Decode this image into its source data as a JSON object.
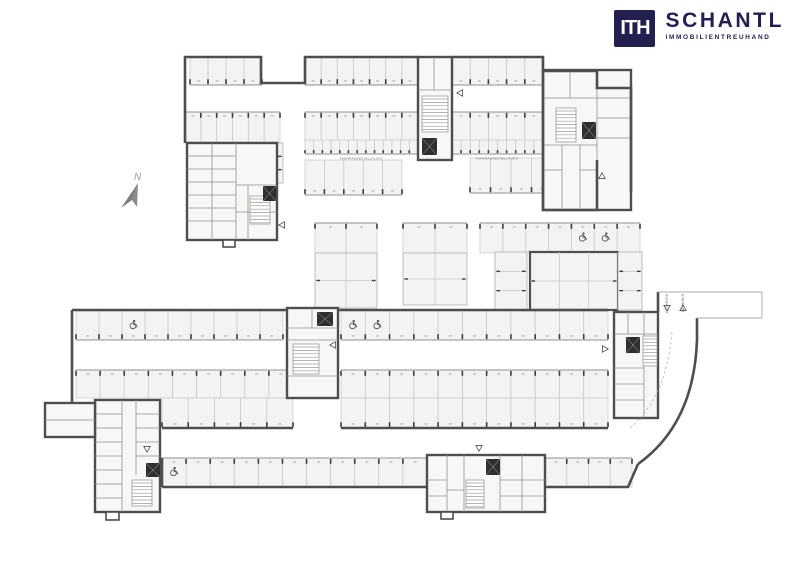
{
  "logo": {
    "mark": "ITH",
    "name": "SCHANTL",
    "tagline": "IMMOBILIENTREUHAND",
    "color": "#23204f"
  },
  "compass": {
    "label": "N"
  },
  "labels": [
    {
      "id": "bike-left",
      "text": "FAHRRADABSTELLPLATZ",
      "x": 361,
      "y": 159.5,
      "size": 3.1,
      "rot": 0
    },
    {
      "id": "bike-right",
      "text": "FAHRRADABSTELLPLATZ",
      "x": 497,
      "y": 159.5,
      "size": 3.1,
      "rot": 0
    },
    {
      "id": "ausfahrt",
      "text": "AUSFAHRT",
      "x": 665.5,
      "y": 294,
      "size": 3.4,
      "rot": 90
    },
    {
      "id": "einfahrt",
      "text": "EINFAHRT",
      "x": 681.5,
      "y": 294,
      "size": 3.4,
      "rot": 90
    }
  ],
  "colors": {
    "wall": "#4e4e4e",
    "stall": "#f3f3f1",
    "stallLine": "#c6c6c3",
    "headLine": "#8f8f8c",
    "tick": "#3c3c3c",
    "icon": "#57575c",
    "room": "#f7f7f5",
    "thin": "#a9a9a6",
    "dash": "#b2b2af",
    "numberDash": "#a0a09d",
    "text": "#6f6f6c",
    "compass": "#8b8b8b"
  },
  "plan": {
    "rows": [
      {
        "x": 190,
        "y": 57,
        "w": 72,
        "h": 28,
        "n": 4,
        "head": "b"
      },
      {
        "x": 305,
        "y": 57,
        "w": 113,
        "h": 28,
        "n": 7,
        "head": "b"
      },
      {
        "x": 452,
        "y": 57,
        "w": 91,
        "h": 28,
        "n": 5,
        "head": "b"
      },
      {
        "x": 185,
        "y": 112,
        "w": 95,
        "h": 30,
        "n": 6,
        "head": "t"
      },
      {
        "x": 305,
        "y": 112,
        "w": 113,
        "h": 30,
        "n": 7,
        "head": "t"
      },
      {
        "x": 452,
        "y": 112,
        "w": 91,
        "h": 30,
        "n": 5,
        "head": "t"
      },
      {
        "x": 305,
        "y": 140,
        "w": 113,
        "h": 14,
        "n": 13,
        "head": "b",
        "bike": true
      },
      {
        "x": 452,
        "y": 140,
        "w": 91,
        "h": 14,
        "n": 10,
        "head": "b",
        "bike": true
      },
      {
        "x": 305,
        "y": 160,
        "w": 97,
        "h": 35,
        "n": 5,
        "head": "b"
      },
      {
        "x": 470,
        "y": 158,
        "w": 123,
        "h": 35,
        "n": 6,
        "head": "b",
        "acc": [
          5
        ]
      },
      {
        "x": 315,
        "y": 223,
        "w": 62,
        "h": 30,
        "n": 2,
        "head": "t"
      },
      {
        "x": 403,
        "y": 223,
        "w": 64,
        "h": 30,
        "n": 2,
        "head": "t"
      },
      {
        "x": 480,
        "y": 223,
        "w": 160,
        "h": 30,
        "n": 7,
        "head": "t",
        "acc": [
          4,
          5
        ]
      },
      {
        "x": 76,
        "y": 311,
        "w": 207,
        "h": 29,
        "n": 9,
        "head": "b",
        "acc": [
          2
        ]
      },
      {
        "x": 341,
        "y": 311,
        "w": 267,
        "h": 29,
        "n": 11,
        "head": "b",
        "acc": [
          0,
          1
        ]
      },
      {
        "x": 76,
        "y": 370,
        "w": 217,
        "h": 28,
        "n": 9,
        "head": "t"
      },
      {
        "x": 341,
        "y": 370,
        "w": 267,
        "h": 28,
        "n": 11,
        "head": "t"
      },
      {
        "x": 162,
        "y": 398,
        "w": 131,
        "h": 30,
        "n": 5,
        "head": "b"
      },
      {
        "x": 341,
        "y": 398,
        "w": 267,
        "h": 30,
        "n": 11,
        "head": "b"
      },
      {
        "x": 162,
        "y": 458,
        "w": 265,
        "h": 29,
        "n": 11,
        "head": "t",
        "acc": [
          0
        ]
      },
      {
        "x": 545,
        "y": 458,
        "w": 87,
        "h": 29,
        "n": 4,
        "head": "t"
      }
    ],
    "grids": [
      {
        "x": 315,
        "y": 253,
        "w": 62,
        "h": 55,
        "cols": 2,
        "rows": 2
      },
      {
        "x": 403,
        "y": 253,
        "w": 64,
        "h": 52,
        "cols": 2,
        "rows": 2
      },
      {
        "x": 495,
        "y": 252,
        "w": 32,
        "h": 58,
        "cols": 1,
        "rows": 3
      },
      {
        "x": 530,
        "y": 252,
        "w": 88,
        "h": 58,
        "cols": 3,
        "rows": 2,
        "thick": true
      },
      {
        "x": 618,
        "y": 252,
        "w": 24,
        "h": 58,
        "cols": 1,
        "rows": 3
      },
      {
        "x": 247,
        "y": 143,
        "w": 36,
        "h": 40,
        "cols": 1,
        "rows": 3
      }
    ],
    "clusters": [
      {
        "name": "storage-cluster-northwest",
        "rect": [
          187,
          143,
          90,
          97
        ],
        "lines": [
          [
            212,
            143,
            212,
            240
          ],
          [
            236,
            143,
            236,
            240
          ],
          [
            187,
            156,
            236,
            156
          ],
          [
            187,
            169,
            236,
            169
          ],
          [
            187,
            182,
            236,
            182
          ],
          [
            187,
            195,
            236,
            195
          ],
          [
            187,
            208,
            236,
            208
          ],
          [
            187,
            221,
            236,
            221
          ],
          [
            236,
            212,
            277,
            212
          ],
          [
            248,
            185,
            248,
            240
          ],
          [
            236,
            185,
            277,
            185
          ]
        ],
        "stairs": [
          [
            250,
            196,
            20,
            28
          ]
        ],
        "lifts": [
          [
            263,
            186,
            13,
            15
          ]
        ],
        "bumps": [
          [
            223,
            240,
            12,
            7
          ]
        ]
      },
      {
        "name": "stair-core-north",
        "rect": [
          418,
          57,
          34,
          103
        ],
        "lines": [
          [
            418,
            90,
            452,
            90
          ],
          [
            434,
            57,
            434,
            90
          ]
        ],
        "stairs": [
          [
            422,
            96,
            26,
            36
          ]
        ],
        "lifts": [
          [
            422,
            138,
            15,
            17
          ]
        ],
        "bumps": []
      },
      {
        "name": "room-block-northeast",
        "rect": [
          543,
          70,
          88,
          140
        ],
        "lines": [
          [
            543,
            98,
            631,
            98
          ],
          [
            570,
            70,
            570,
            98
          ],
          [
            597,
            70,
            597,
            160
          ],
          [
            597,
            118,
            631,
            118
          ],
          [
            597,
            138,
            631,
            138
          ],
          [
            543,
            145,
            597,
            145
          ],
          [
            562,
            145,
            562,
            208
          ],
          [
            580,
            145,
            580,
            208
          ],
          [
            543,
            170,
            562,
            170
          ],
          [
            580,
            170,
            597,
            170
          ]
        ],
        "stairs": [
          [
            556,
            108,
            20,
            34
          ]
        ],
        "lifts": [
          [
            582,
            122,
            14,
            17
          ]
        ],
        "bumps": []
      },
      {
        "name": "stair-core-center",
        "rect": [
          287,
          308,
          51,
          90
        ],
        "lines": [
          [
            287,
            328,
            338,
            328
          ],
          [
            312,
            308,
            312,
            328
          ],
          [
            287,
            340,
            338,
            340
          ],
          [
            287,
            376,
            338,
            376
          ]
        ],
        "stairs": [
          [
            293,
            344,
            26,
            30
          ]
        ],
        "lifts": [
          [
            317,
            312,
            16,
            14
          ]
        ],
        "bumps": []
      },
      {
        "name": "stair-core-east",
        "rect": [
          614,
          312,
          44,
          106
        ],
        "lines": [
          [
            614,
            334,
            658,
            334
          ],
          [
            628,
            312,
            628,
            334
          ],
          [
            644,
            312,
            644,
            334
          ],
          [
            614,
            368,
            644,
            368
          ],
          [
            614,
            384,
            644,
            384
          ],
          [
            614,
            400,
            644,
            400
          ],
          [
            644,
            334,
            644,
            418
          ]
        ],
        "stairs": [
          [
            643,
            336,
            14,
            30
          ]
        ],
        "lifts": [
          [
            626,
            337,
            14,
            16
          ]
        ],
        "bumps": []
      },
      {
        "name": "storage-cluster-southwest",
        "rect": [
          95,
          400,
          65,
          112
        ],
        "lines": [
          [
            122,
            400,
            122,
            512
          ],
          [
            136,
            400,
            136,
            475
          ],
          [
            95,
            414,
            122,
            414
          ],
          [
            95,
            428,
            122,
            428
          ],
          [
            95,
            442,
            122,
            442
          ],
          [
            95,
            456,
            122,
            456
          ],
          [
            95,
            470,
            122,
            470
          ],
          [
            95,
            484,
            122,
            484
          ],
          [
            95,
            498,
            122,
            498
          ],
          [
            136,
            414,
            160,
            414
          ],
          [
            136,
            428,
            160,
            428
          ],
          [
            136,
            442,
            160,
            442
          ],
          [
            136,
            456,
            160,
            456
          ]
        ],
        "stairs": [
          [
            132,
            480,
            20,
            26
          ]
        ],
        "lifts": [
          [
            146,
            463,
            14,
            14
          ]
        ],
        "bumps": [
          [
            106,
            512,
            13,
            8
          ]
        ]
      },
      {
        "name": "storage-cluster-south",
        "rect": [
          427,
          455,
          118,
          57
        ],
        "lines": [
          [
            447,
            455,
            447,
            512
          ],
          [
            464,
            455,
            464,
            512
          ],
          [
            427,
            480,
            447,
            480
          ],
          [
            427,
            496,
            447,
            496
          ],
          [
            500,
            455,
            500,
            512
          ],
          [
            522,
            455,
            522,
            512
          ],
          [
            500,
            480,
            545,
            480
          ],
          [
            500,
            496,
            545,
            496
          ],
          [
            447,
            490,
            464,
            490
          ]
        ],
        "stairs": [
          [
            466,
            480,
            18,
            28
          ]
        ],
        "lifts": [
          [
            486,
            459,
            14,
            16
          ]
        ],
        "bumps": [
          [
            441,
            512,
            12,
            7
          ]
        ]
      },
      {
        "name": "annex-room-west",
        "rect": [
          45,
          403,
          50,
          34
        ],
        "lines": [
          [
            45,
            420,
            95,
            420
          ]
        ],
        "stairs": [],
        "lifts": [],
        "bumps": []
      }
    ],
    "walls": {
      "thick": [
        "M185,143 V57 H261 V83 H305 V57 H418",
        "M452,57 H543 V71 H597 V88 H631 V192",
        "M543,71 V210 H597 V160",
        "M72,310 H287",
        "M338,310 H608",
        "M72,310 V403",
        "M162,428 H293",
        "M341,428 H608",
        "M162,458 V487",
        "M162,487 H427",
        "M545,487 H628 L638,464",
        "M697,340 V318",
        "M697,340 Q694,424 638,464",
        "M658,312 V292"
      ],
      "thin": [
        "M658,292 H762",
        "M697,318 H762",
        "M762,292 V318"
      ],
      "dashed": [
        "M630,428 Q666,398 672,332"
      ]
    },
    "arrows": [
      {
        "type": "left",
        "x": 282,
        "y": 225
      },
      {
        "type": "left",
        "x": 460,
        "y": 93
      },
      {
        "type": "up",
        "x": 602,
        "y": 176
      },
      {
        "type": "left",
        "x": 333,
        "y": 345
      },
      {
        "type": "right",
        "x": 605,
        "y": 349
      },
      {
        "type": "down",
        "x": 147,
        "y": 449
      },
      {
        "type": "down",
        "x": 479,
        "y": 448
      },
      {
        "type": "down",
        "x": 667,
        "y": 308
      },
      {
        "type": "up",
        "x": 683,
        "y": 308
      }
    ],
    "compassArrow": {
      "dark": "138,183 121,208 132,200",
      "light": "138,183 132,200 137,207",
      "labelX": 134,
      "labelY": 180
    }
  }
}
